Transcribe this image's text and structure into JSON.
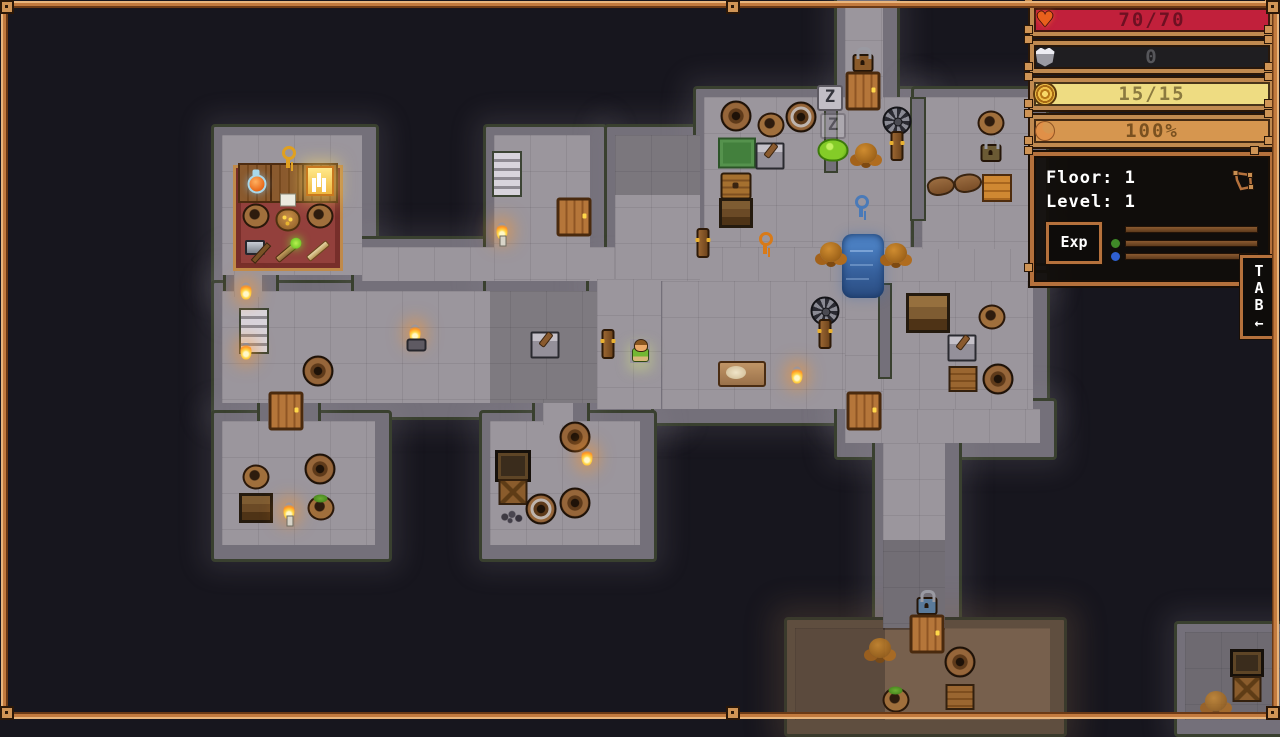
{
  "hud": {
    "bars": [
      {
        "label": "health",
        "icon": "heart-icon",
        "value": "70/70",
        "bar_color": "#c1203b",
        "text_color": "#6e1022"
      },
      {
        "label": "armor",
        "icon": "armor-icon",
        "value": "0",
        "bar_color": "#1f1e21",
        "text_color": "#56565a"
      },
      {
        "label": "resource",
        "icon": "gold-coil-icon",
        "value": "15/15",
        "bar_color": "#eedc82",
        "text_color": "#8b7a40"
      },
      {
        "label": "satiation",
        "icon": "crescent-icon",
        "value": "100%",
        "bar_color": "#d6964f",
        "text_color": "#7a5120"
      }
    ],
    "info_panel": {
      "floor": "Floor: 1",
      "level": "Level: 1",
      "exp_label": "Exp",
      "map_icon": "map-icon",
      "dot_colors": [
        "#3f8a28",
        "#2f5fd0"
      ]
    },
    "tab": {
      "letters": "T\nA\nB",
      "arrow": "←"
    }
  },
  "map": {
    "colors": {
      "void": "#17161e",
      "floor": "#9b969d",
      "wall": "#74707a",
      "moss": "#39402f",
      "dirt": "#77604d",
      "water": "#36609c",
      "frame": "#b5713c"
    },
    "regions": [
      {
        "id": "shop-room",
        "x": 222,
        "y": 135,
        "w": 140,
        "h": 140
      },
      {
        "id": "hall",
        "x": 222,
        "y": 291,
        "w": 375,
        "h": 112
      },
      {
        "id": "corridor-main",
        "x": 362,
        "y": 247,
        "w": 670,
        "h": 34
      },
      {
        "id": "stair-column",
        "x": 494,
        "y": 135,
        "w": 96,
        "h": 146
      },
      {
        "id": "mid-corridor",
        "x": 615,
        "y": 135,
        "w": 85,
        "h": 146
      },
      {
        "id": "player-corridor",
        "x": 597,
        "y": 279,
        "w": 64,
        "h": 130
      },
      {
        "id": "storage-room",
        "x": 704,
        "y": 97,
        "w": 206,
        "h": 150
      },
      {
        "id": "top-corridor",
        "x": 845,
        "y": 4,
        "w": 38,
        "h": 95
      },
      {
        "id": "room-top-right",
        "x": 922,
        "y": 97,
        "w": 110,
        "h": 152
      },
      {
        "id": "room-mid",
        "x": 662,
        "y": 281,
        "w": 183,
        "h": 128
      },
      {
        "id": "corridor-west",
        "x": 845,
        "y": 247,
        "w": 38,
        "h": 162
      },
      {
        "id": "room-right",
        "x": 883,
        "y": 281,
        "w": 150,
        "h": 128
      },
      {
        "id": "corridor-row-2",
        "x": 845,
        "y": 409,
        "w": 195,
        "h": 34
      },
      {
        "id": "corridor-south",
        "x": 883,
        "y": 443,
        "w": 62,
        "h": 187
      },
      {
        "id": "room-sw",
        "x": 222,
        "y": 421,
        "w": 153,
        "h": 124
      },
      {
        "id": "room-s",
        "x": 490,
        "y": 421,
        "w": 150,
        "h": 124
      },
      {
        "id": "cave",
        "x": 795,
        "y": 628,
        "w": 255,
        "h": 92,
        "f": "dirt"
      },
      {
        "id": "room-se",
        "x": 1185,
        "y": 632,
        "w": 95,
        "h": 88
      },
      {
        "id": "passage-shop",
        "x": 234,
        "y": 267,
        "w": 28,
        "h": 30
      },
      {
        "id": "passage-sw",
        "x": 268,
        "y": 399,
        "w": 36,
        "h": 26
      },
      {
        "id": "passage-s",
        "x": 543,
        "y": 399,
        "w": 30,
        "h": 26
      }
    ],
    "wall_segments": [
      {
        "x": 824,
        "y": 97,
        "w": 10,
        "h": 72
      },
      {
        "x": 910,
        "y": 97,
        "w": 12,
        "h": 120
      },
      {
        "x": 878,
        "y": 283,
        "w": 10,
        "h": 92
      }
    ],
    "shadows": [
      {
        "x": 490,
        "y": 291,
        "w": 107,
        "h": 112,
        "a": 0.2
      },
      {
        "x": 615,
        "y": 135,
        "w": 85,
        "h": 60,
        "a": 0.22
      },
      {
        "x": 883,
        "y": 540,
        "w": 62,
        "h": 90,
        "a": 0.28
      },
      {
        "x": 795,
        "y": 628,
        "w": 90,
        "h": 92,
        "a": 0.25
      },
      {
        "x": 1185,
        "y": 632,
        "w": 95,
        "h": 88,
        "a": 0.3
      }
    ],
    "objects": [
      {
        "t": "carpet",
        "x": 288,
        "y": 218,
        "w": 104,
        "h": 100
      },
      {
        "t": "tabletile",
        "x": 256,
        "y": 183
      },
      {
        "t": "tabletile",
        "x": 288,
        "y": 183
      },
      {
        "t": "tabletile",
        "x": 320,
        "y": 183
      },
      {
        "t": "key",
        "x": 288,
        "y": 157,
        "tint": "#e0a020"
      },
      {
        "t": "potion",
        "x": 257,
        "y": 184
      },
      {
        "t": "tome",
        "x": 320,
        "y": 181
      },
      {
        "t": "pot",
        "x": 256,
        "y": 216
      },
      {
        "t": "tag",
        "x": 288,
        "y": 200
      },
      {
        "t": "sack",
        "x": 288,
        "y": 220
      },
      {
        "t": "pot",
        "x": 320,
        "y": 216
      },
      {
        "t": "axe",
        "x": 258,
        "y": 251
      },
      {
        "t": "wandgreen",
        "x": 287,
        "y": 252
      },
      {
        "t": "wand",
        "x": 318,
        "y": 251
      },
      {
        "t": "flame",
        "x": 246,
        "y": 291
      },
      {
        "t": "flame",
        "x": 246,
        "y": 351
      },
      {
        "t": "stairs",
        "x": 254,
        "y": 331
      },
      {
        "t": "barrel",
        "x": 318,
        "y": 371
      },
      {
        "t": "torchstand",
        "x": 415,
        "y": 333
      },
      {
        "t": "mortar",
        "x": 545,
        "y": 345
      },
      {
        "t": "post",
        "x": 608,
        "y": 344
      },
      {
        "t": "player",
        "x": 640,
        "y": 351
      },
      {
        "t": "door",
        "x": 286,
        "y": 411
      },
      {
        "t": "stairs",
        "x": 507,
        "y": 174
      },
      {
        "t": "door",
        "x": 574,
        "y": 217
      },
      {
        "t": "candle",
        "x": 502,
        "y": 231
      },
      {
        "t": "post",
        "x": 703,
        "y": 243
      },
      {
        "t": "key",
        "x": 765,
        "y": 243,
        "tint": "#d87a18"
      },
      {
        "t": "water",
        "x": 863,
        "y": 266,
        "w": 42,
        "h": 64
      },
      {
        "t": "tree",
        "x": 831,
        "y": 252
      },
      {
        "t": "tree",
        "x": 896,
        "y": 253
      },
      {
        "t": "key",
        "x": 861,
        "y": 206,
        "tint": "#4a7ab8"
      },
      {
        "t": "barrel",
        "x": 736,
        "y": 116
      },
      {
        "t": "pot",
        "x": 771,
        "y": 125
      },
      {
        "t": "barrelband",
        "x": 801,
        "y": 117
      },
      {
        "t": "ruggreen",
        "x": 737,
        "y": 153
      },
      {
        "t": "mortar",
        "x": 770,
        "y": 156
      },
      {
        "t": "chest",
        "x": 736,
        "y": 186
      },
      {
        "t": "shelf",
        "x": 736,
        "y": 213
      },
      {
        "t": "zzz",
        "x": 830,
        "y": 98,
        "text": "Z"
      },
      {
        "t": "zzz",
        "x": 833,
        "y": 126,
        "text": "Z",
        "op": 0.45
      },
      {
        "t": "slime",
        "x": 833,
        "y": 150
      },
      {
        "t": "tree",
        "x": 866,
        "y": 153
      },
      {
        "t": "windmill",
        "x": 897,
        "y": 121
      },
      {
        "t": "post",
        "x": 897,
        "y": 146
      },
      {
        "t": "padlock",
        "x": 863,
        "y": 63,
        "tint": "#8a5a2a"
      },
      {
        "t": "door",
        "x": 863,
        "y": 91
      },
      {
        "t": "pot",
        "x": 991,
        "y": 123
      },
      {
        "t": "padlock",
        "x": 991,
        "y": 153,
        "tint": "#6b5a34"
      },
      {
        "t": "glove",
        "x": 941,
        "y": 186
      },
      {
        "t": "glove",
        "x": 968,
        "y": 183
      },
      {
        "t": "crateorange",
        "x": 997,
        "y": 188
      },
      {
        "t": "windmill",
        "x": 825,
        "y": 311
      },
      {
        "t": "post",
        "x": 825,
        "y": 334
      },
      {
        "t": "bench",
        "x": 742,
        "y": 374
      },
      {
        "t": "flame",
        "x": 797,
        "y": 375
      },
      {
        "t": "bigshelf",
        "x": 928,
        "y": 313
      },
      {
        "t": "pot",
        "x": 992,
        "y": 317
      },
      {
        "t": "mortar",
        "x": 962,
        "y": 348
      },
      {
        "t": "crate",
        "x": 963,
        "y": 379
      },
      {
        "t": "barrel",
        "x": 998,
        "y": 379
      },
      {
        "t": "door",
        "x": 864,
        "y": 411
      },
      {
        "t": "padlock",
        "x": 927,
        "y": 606,
        "tint": "#5a7a9a"
      },
      {
        "t": "door",
        "x": 927,
        "y": 634
      },
      {
        "t": "tree",
        "x": 880,
        "y": 648,
        "op": 0.85
      },
      {
        "t": "barrel",
        "x": 960,
        "y": 662
      },
      {
        "t": "crate",
        "x": 960,
        "y": 697
      },
      {
        "t": "potgreens",
        "x": 896,
        "y": 700
      },
      {
        "t": "chestdark",
        "x": 1247,
        "y": 663
      },
      {
        "t": "cratex",
        "x": 1247,
        "y": 689
      },
      {
        "t": "tree",
        "x": 1216,
        "y": 701,
        "op": 0.8
      },
      {
        "t": "pot",
        "x": 256,
        "y": 477
      },
      {
        "t": "shelf",
        "x": 256,
        "y": 508
      },
      {
        "t": "candle",
        "x": 289,
        "y": 511
      },
      {
        "t": "barrel",
        "x": 320,
        "y": 469
      },
      {
        "t": "potgreens",
        "x": 321,
        "y": 508
      },
      {
        "t": "barrel",
        "x": 575,
        "y": 437
      },
      {
        "t": "flame",
        "x": 587,
        "y": 457
      },
      {
        "t": "shelfdark",
        "x": 513,
        "y": 466
      },
      {
        "t": "cratex",
        "x": 513,
        "y": 492
      },
      {
        "t": "pebbles",
        "x": 512,
        "y": 517
      },
      {
        "t": "barrelband",
        "x": 541,
        "y": 509
      },
      {
        "t": "barrel",
        "x": 575,
        "y": 503
      }
    ]
  }
}
